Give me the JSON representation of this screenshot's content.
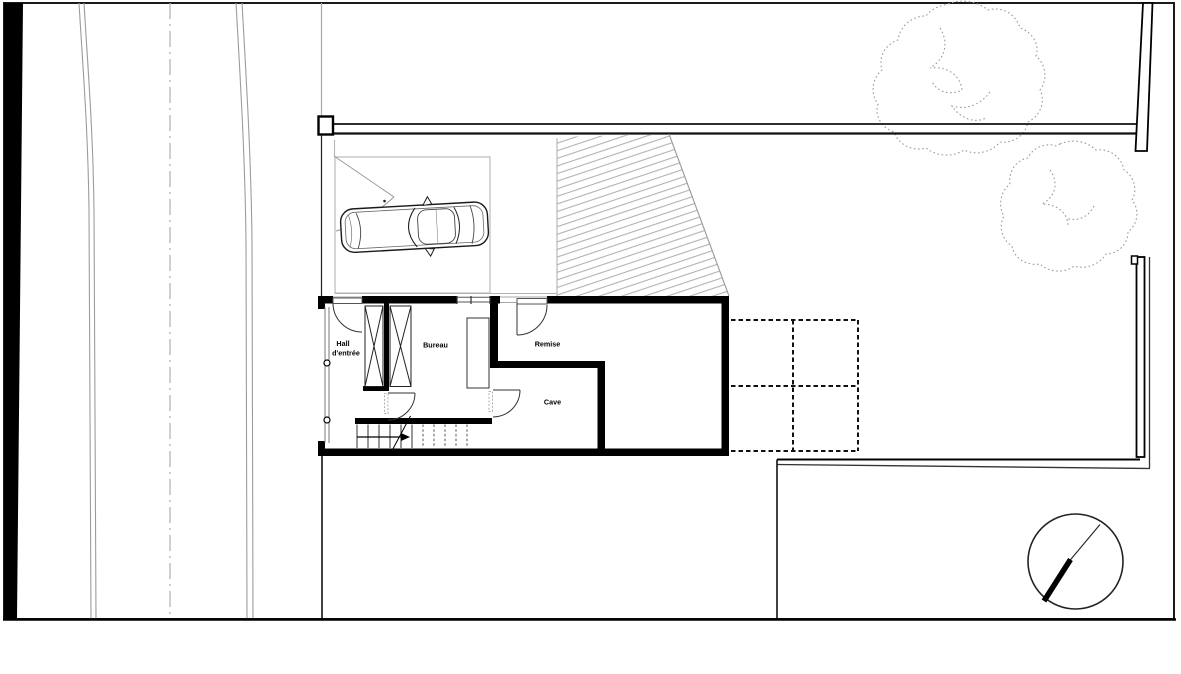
{
  "page": {
    "background": "#ffffff"
  },
  "drawing": {
    "type": "architectural site and basement floor plan",
    "rooms": {
      "hall": {
        "line1": "Hall",
        "line2": "d'entrée"
      },
      "bureau": "Bureau",
      "remise": "Remise",
      "cave": "Cave"
    },
    "colors": {
      "ink": "#000000",
      "wall_black": "#111111",
      "road_gray": "#9c9c9c",
      "carport_gray": "#b3b3b3",
      "hatch_gray": "#aaaaaa",
      "tree_gray": "#9a9a9a",
      "paper_white": "#ffffff"
    }
  }
}
